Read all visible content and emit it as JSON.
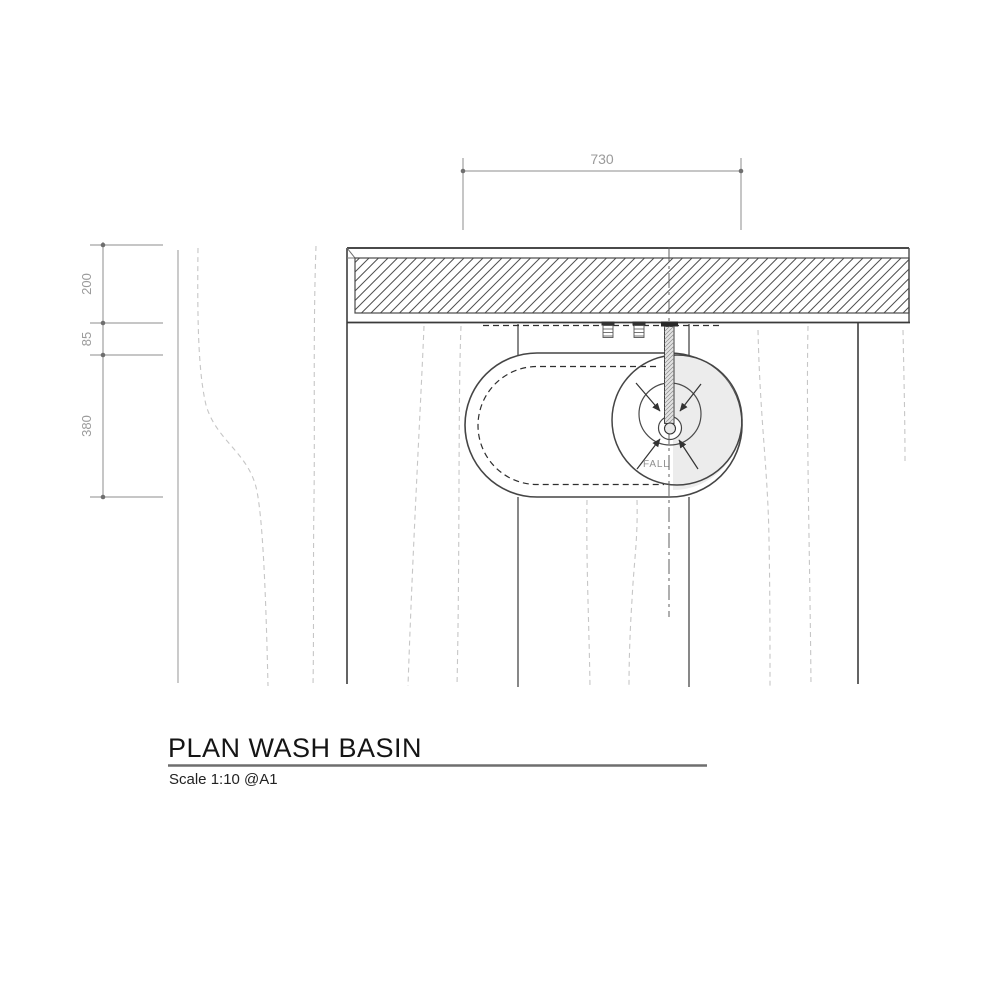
{
  "title": "PLAN WASH BASIN",
  "scale_note": "Scale 1:10 @A1",
  "dimensions": {
    "top_width": "730",
    "left_chain": [
      "200",
      "85",
      "380"
    ]
  },
  "annotations": {
    "fall": "FALL"
  },
  "colors": {
    "ink": "#3d3d3d",
    "dimension_gray": "#9a9a9a",
    "wood_grain_gray": "#c6c6c6",
    "basin_shade": "#ececec",
    "paper": "#ffffff"
  }
}
